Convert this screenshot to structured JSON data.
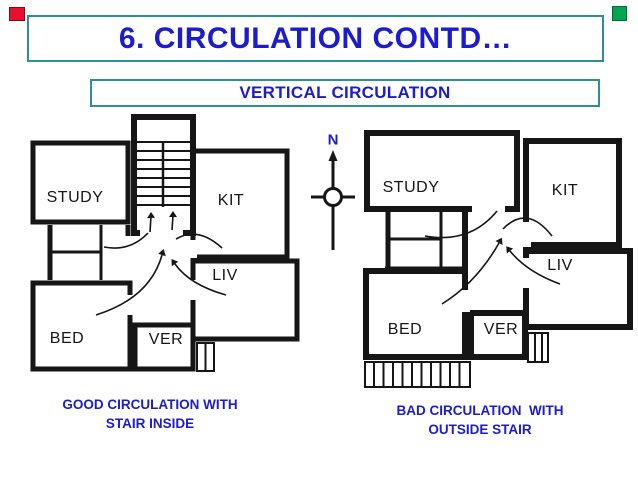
{
  "slide": {
    "title": "6. CIRCULATION CONTD…",
    "subtitle": "VERTICAL CIRCULATION"
  },
  "colors": {
    "text_blue": "#1b1bd0",
    "border_teal": "#2e8f96",
    "marker_red": "#e8112d",
    "marker_green": "#00a651",
    "plan_line_black": "#161616"
  },
  "north_indicator": {
    "label": "N"
  },
  "left_plan": {
    "rooms": {
      "study": "STUDY",
      "kit": "KIT",
      "liv": "LIV",
      "bed": "BED",
      "ver": "VER"
    },
    "caption": [
      "GOOD CIRCULATION WITH",
      "STAIR INSIDE"
    ]
  },
  "right_plan": {
    "rooms": {
      "study": "STUDY",
      "kit": "KIT",
      "liv": "LIV",
      "bed": "BED",
      "ver": "VER"
    },
    "caption": [
      "BAD CIRCULATION  WITH",
      "OUTSIDE STAIR"
    ]
  }
}
